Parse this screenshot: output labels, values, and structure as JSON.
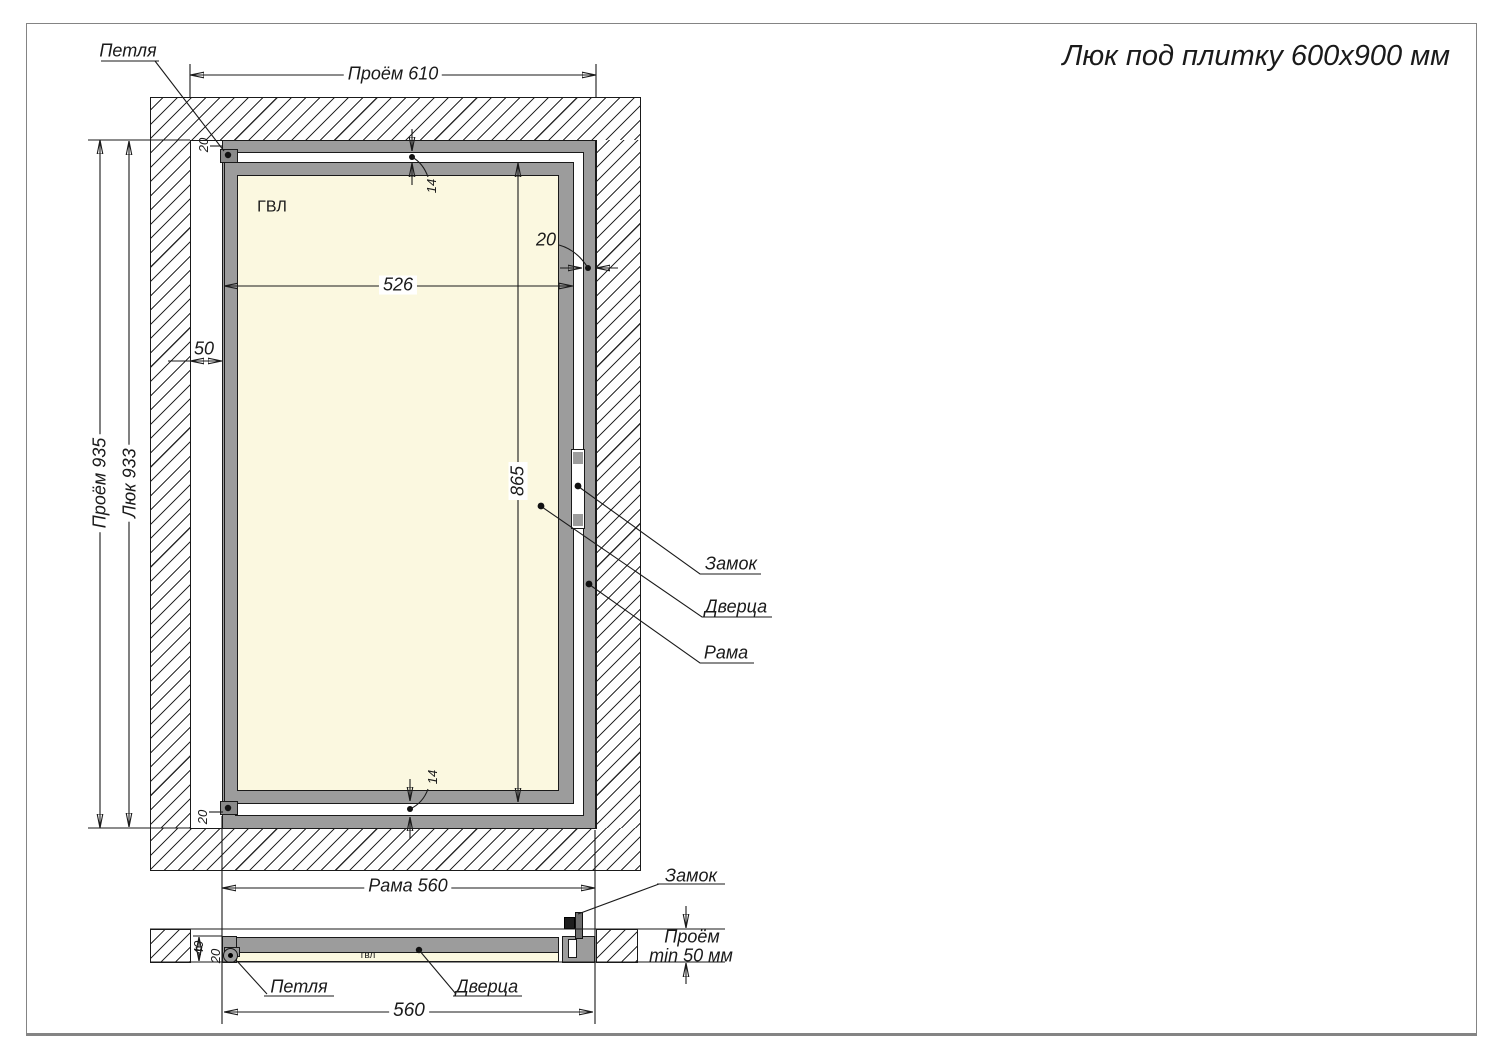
{
  "title": "Люк под плитку 600х900 мм",
  "front_view": {
    "labels": {
      "hinge": "Петля",
      "panel": "ГВЛ",
      "lock": "Замок",
      "door": "Дверца",
      "frame": "Рама"
    },
    "dimensions": {
      "opening_width": "Проём 610",
      "opening_height": "Проём 935",
      "hatch_height": "Люк 933",
      "side_gap": "50",
      "door_width": "526",
      "door_height": "865",
      "frame_profile_top": "20",
      "frame_profile_right": "20",
      "frame_profile_bottom": "20",
      "door_gap_top": "14",
      "door_gap_bottom": "14",
      "frame_width": "Рама 560"
    }
  },
  "section_view": {
    "labels": {
      "lock": "Замок",
      "hinge": "Петля",
      "door": "Дверца",
      "panel": "гвл"
    },
    "dimensions": {
      "frame_width": "560",
      "frame_depth": "40",
      "frame_profile": "20",
      "opening_depth_line1": "Проём",
      "opening_depth_line2": "min 50 мм"
    }
  },
  "colors": {
    "metal_gray": "#9c9c9c",
    "panel_cream": "#fbf8e0",
    "line_black": "#1a1a1a",
    "border_gray": "#848484"
  }
}
